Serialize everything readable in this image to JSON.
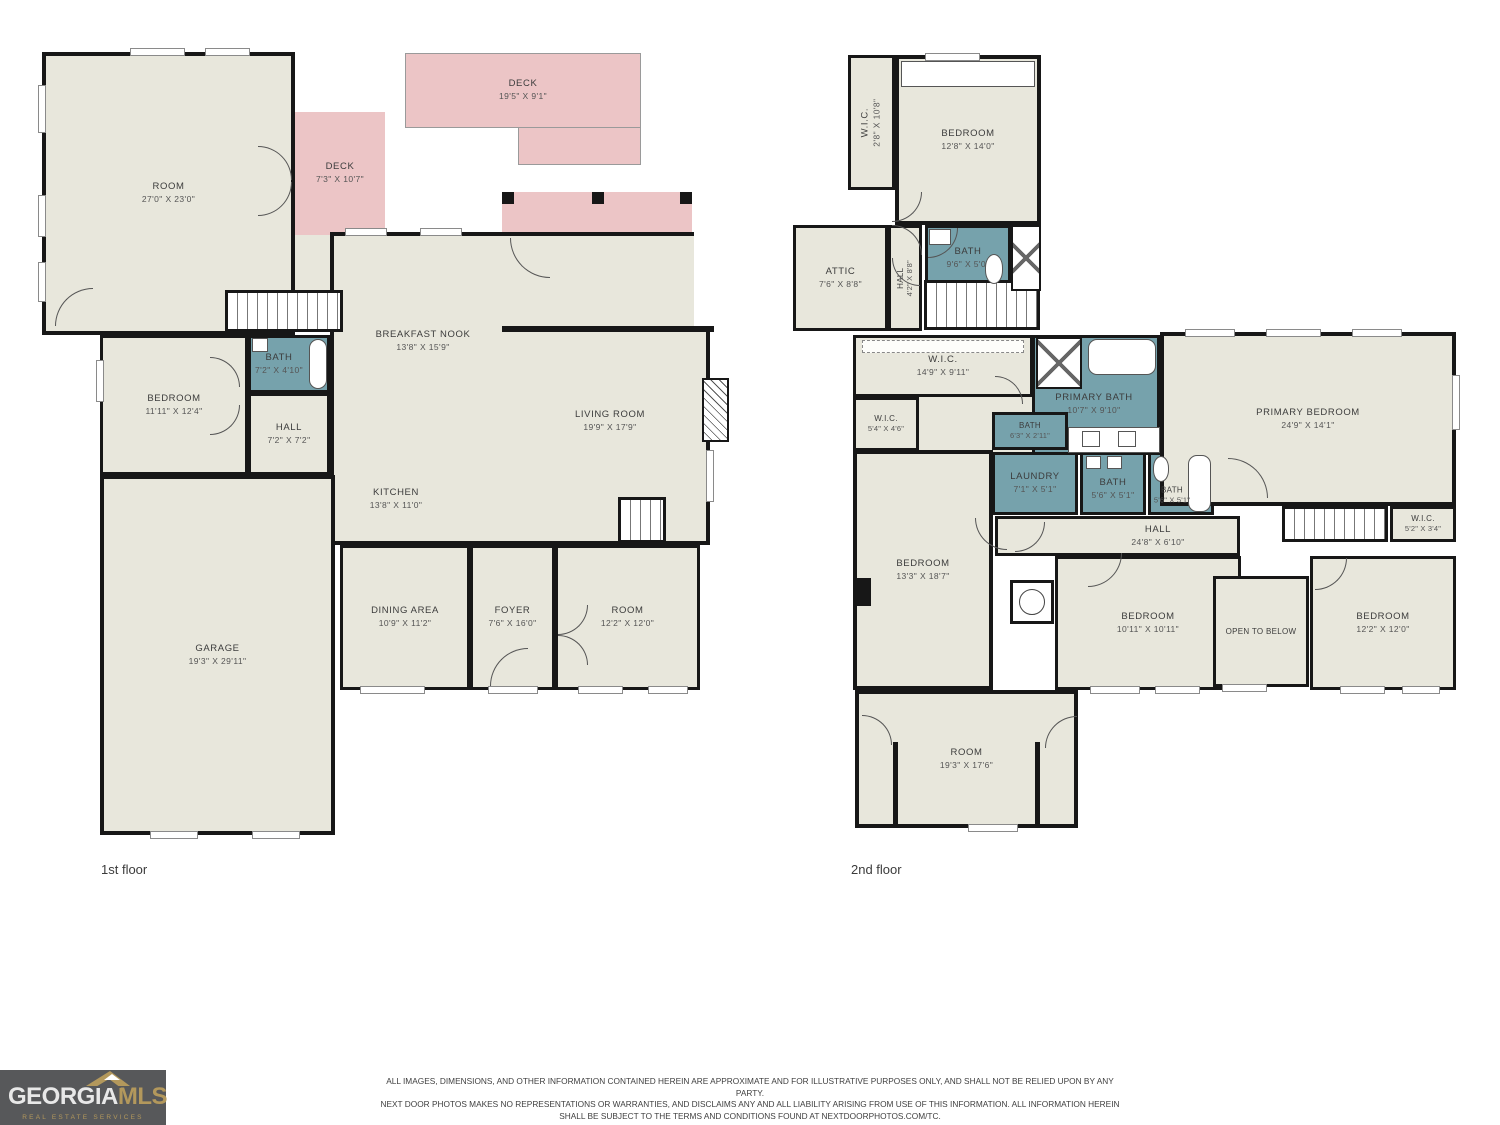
{
  "colors": {
    "interior": "#e8e7dc",
    "outdoor": "#ecc5c6",
    "wet": "#76a2ac",
    "wall": "#171717",
    "logo_bg": "#57585a",
    "logo_gold": "#b3985c"
  },
  "floor1": {
    "label": "1st floor",
    "rooms": [
      {
        "name": "ROOM",
        "dims": "27'0\" X 23'0\""
      },
      {
        "name": "DECK",
        "dims": "7'3\" X 10'7\""
      },
      {
        "name": "DECK",
        "dims": "19'5\" X 9'1\""
      },
      {
        "name": "PATIO",
        "dims": "16'1\" X 11'4\""
      },
      {
        "name": "BREAKFAST NOOK",
        "dims": "13'8\" X 15'9\""
      },
      {
        "name": "LIVING ROOM",
        "dims": "19'9\" X 17'9\""
      },
      {
        "name": "KITCHEN",
        "dims": "13'8\" X 11'0\""
      },
      {
        "name": "BEDROOM",
        "dims": "11'11\" X 12'4\""
      },
      {
        "name": "BATH",
        "dims": "7'2\" X 4'10\""
      },
      {
        "name": "HALL",
        "dims": "7'2\" X 7'2\""
      },
      {
        "name": "GARAGE",
        "dims": "19'3\" X 29'11\""
      },
      {
        "name": "DINING AREA",
        "dims": "10'9\" X 11'2\""
      },
      {
        "name": "FOYER",
        "dims": "7'6\" X 16'0\""
      },
      {
        "name": "ROOM",
        "dims": "12'2\" X 12'0\""
      }
    ]
  },
  "floor2": {
    "label": "2nd floor",
    "rooms": [
      {
        "name": "W.I.C.",
        "dims": "2'8\" X 10'8\""
      },
      {
        "name": "BEDROOM",
        "dims": "12'8\" X 14'0\""
      },
      {
        "name": "BATH",
        "dims": "9'6\" X 5'0\""
      },
      {
        "name": "ATTIC",
        "dims": "7'6\" X 8'8\""
      },
      {
        "name": "HALL",
        "dims": "4'2\" X 8'8\""
      },
      {
        "name": "W.I.C.",
        "dims": "14'9\" X 9'11\""
      },
      {
        "name": "W.I.C.",
        "dims": "5'4\" X 4'6\""
      },
      {
        "name": "PRIMARY BATH",
        "dims": "10'7\" X 9'10\""
      },
      {
        "name": "BATH",
        "dims": "6'3\" X 2'11\""
      },
      {
        "name": "LAUNDRY",
        "dims": "7'1\" X 5'1\""
      },
      {
        "name": "BATH",
        "dims": "5'6\" X 5'1\""
      },
      {
        "name": "BATH",
        "dims": "5'6\" X 5'1\""
      },
      {
        "name": "PRIMARY BEDROOM",
        "dims": "24'9\" X 14'1\""
      },
      {
        "name": "HALL",
        "dims": "24'8\" X 6'10\""
      },
      {
        "name": "W.I.C.",
        "dims": "5'2\" X 3'4\""
      },
      {
        "name": "BEDROOM",
        "dims": "13'3\" X 18'7\""
      },
      {
        "name": "BEDROOM",
        "dims": "10'11\" X 10'11\""
      },
      {
        "name": "OPEN TO BELOW",
        "dims": ""
      },
      {
        "name": "BEDROOM",
        "dims": "12'2\" X 12'0\""
      },
      {
        "name": "ROOM",
        "dims": "19'3\" X 17'6\""
      }
    ]
  },
  "footer": {
    "disclaimer": [
      "ALL IMAGES, DIMENSIONS, AND OTHER INFORMATION CONTAINED HEREIN ARE APPROXIMATE AND FOR ILLUSTRATIVE PURPOSES ONLY, AND SHALL NOT BE RELIED UPON BY ANY PARTY.",
      "NEXT DOOR PHOTOS MAKES NO REPRESENTATIONS OR WARRANTIES, AND DISCLAIMS ANY AND ALL LIABILITY ARISING FROM USE OF THIS INFORMATION. ALL INFORMATION HEREIN",
      "SHALL BE SUBJECT TO THE TERMS AND CONDITIONS FOUND AT NEXTDOORPHOTOS.COM/TC."
    ]
  },
  "logo": {
    "brand_primary": "GEORGIA",
    "brand_secondary": "MLS",
    "tagline": "REAL ESTATE SERVICES"
  }
}
